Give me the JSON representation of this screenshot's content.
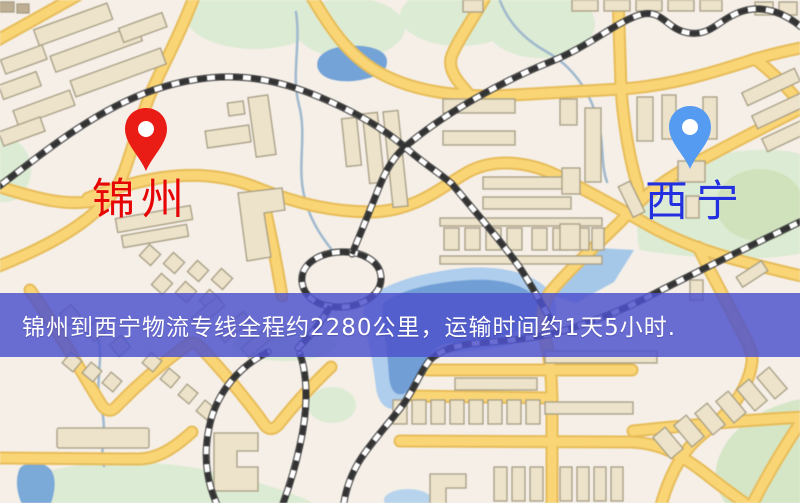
{
  "window": {
    "type": "logistics-route-map-screenshot",
    "width": 800,
    "height": 503
  },
  "map": {
    "origin_marker": {
      "label": "锦州",
      "icon": "location-pin-icon",
      "pin_color": "#ea1c16",
      "label_color": "#e60404"
    },
    "destination_marker": {
      "label": "西宁",
      "icon": "location-pin-icon",
      "pin_color": "#569bf2",
      "label_color": "#2230e0"
    },
    "style_colors": {
      "background": "#f5efe8",
      "road_fill": "#fbd572",
      "road_casing": "#e9bc55",
      "building_fill": "#ece3c9",
      "building_stroke": "#a79d82",
      "park": "#dcebd2",
      "water": "#6f9fd8",
      "railway": "#333333"
    }
  },
  "banner": {
    "text": "锦州到西宁物流专线全程约2280公里，运输时间约1天5小时.",
    "background_color": "#4d52cc",
    "text_color": "#ffffff"
  }
}
